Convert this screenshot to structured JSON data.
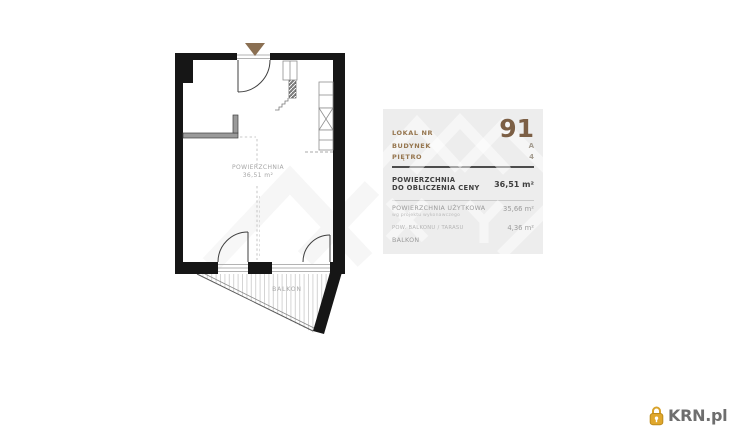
{
  "plan": {
    "room_area_label": "POWIERZCHNIA",
    "room_area_value": "36,51 m²",
    "balcony_label": "BALKON"
  },
  "panel": {
    "unit": {
      "label": "LOKAL NR",
      "value": "91"
    },
    "building": {
      "label": "BUDYNEK",
      "value": "A"
    },
    "floor": {
      "label": "PIĘTRO",
      "value": "4"
    },
    "price_area": {
      "label_line1": "POWIERZCHNIA",
      "label_line2": "DO OBLICZENIA CENY",
      "value": "36,51 m²"
    },
    "usable_area": {
      "label": "POWIERZCHNIA UŻYTKOWA",
      "note": "wg projektu wykonawczego",
      "value": "35,66 m²"
    },
    "outdoor_area": {
      "label": "POW. BALKONU / TARASU",
      "value": "4,36 m²"
    },
    "outdoor_item_label": "BALKON"
  },
  "branding": {
    "site": "KRN.pl"
  },
  "colors": {
    "accent_brown": "#8a6f52",
    "panel_bg": "#ededed",
    "wall_black": "#161616",
    "logo_gold": "#e0a72c"
  }
}
